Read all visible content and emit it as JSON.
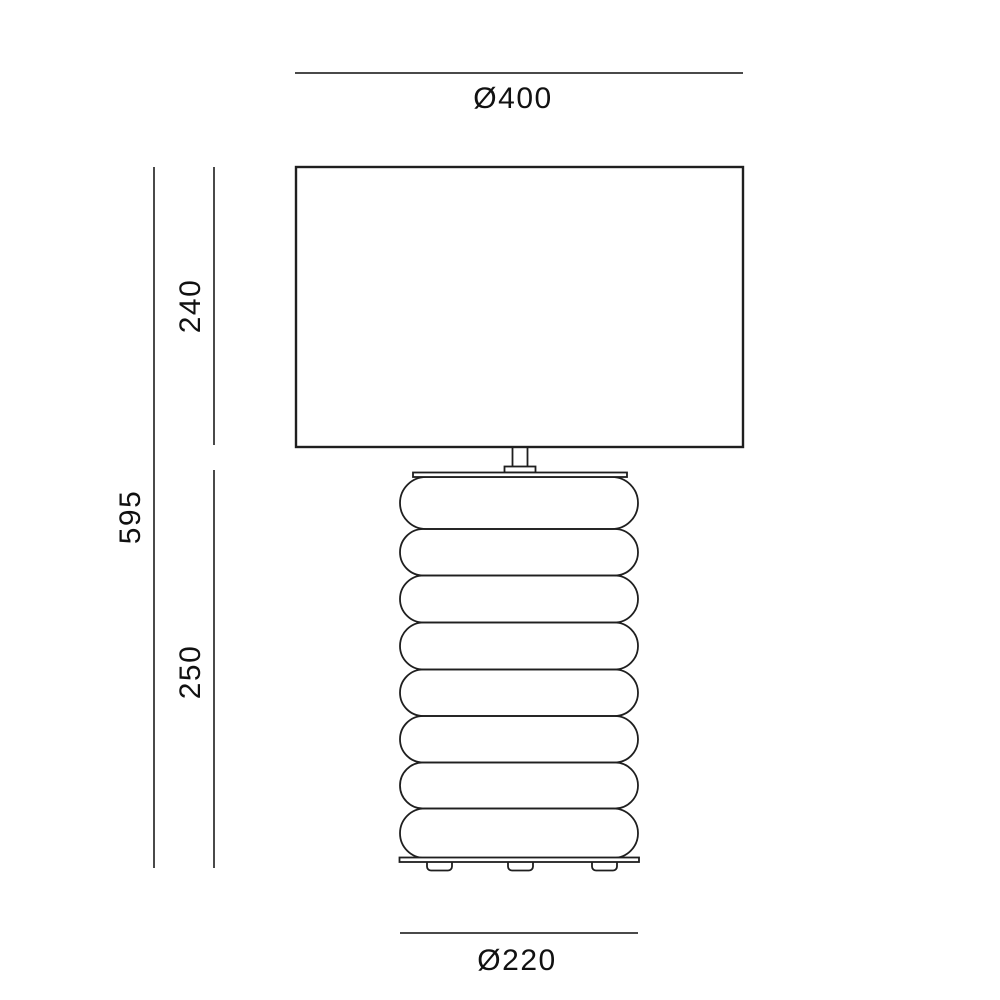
{
  "diagram": {
    "type": "product-dimension-drawing",
    "subject": "table-lamp-with-rectangular-shade-and-bubble-body",
    "labels": {
      "shade_diameter": "Ø400",
      "shade_height": "240",
      "total_height": "595",
      "body_height": "250",
      "base_diameter": "Ø220"
    },
    "units_shown": "millimeters-implied",
    "colors": {
      "background": "#ffffff",
      "outline": "#1f1f1f",
      "dimension_line": "#4a4a4a",
      "label_text": "#111111"
    }
  }
}
